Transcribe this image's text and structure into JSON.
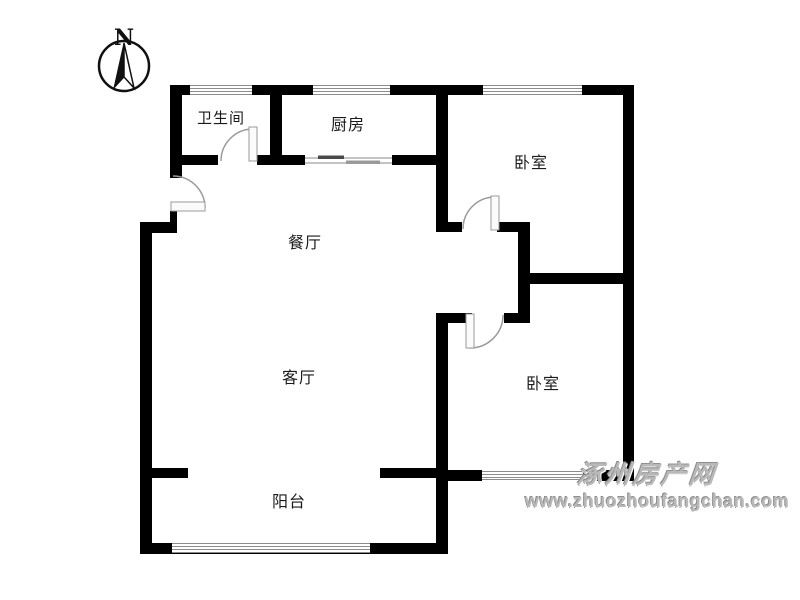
{
  "compass": {
    "north_label": "N"
  },
  "rooms": {
    "bathroom": "卫生间",
    "kitchen": "厨房",
    "bedroom_top": "卧室",
    "dining": "餐厅",
    "living": "客厅",
    "bedroom_bottom": "卧室",
    "balcony": "阳台"
  },
  "watermark": {
    "site_name": "涿州房产网",
    "site_url": "www.zhuozhoufangchan.com"
  },
  "colors": {
    "wall": "#000000",
    "window_line": "#8c8c8c",
    "door_symbol": "#9a9a9a",
    "label_text": "#1a1a1a",
    "watermark_gray": "#8f8f8f",
    "background": "#ffffff"
  }
}
